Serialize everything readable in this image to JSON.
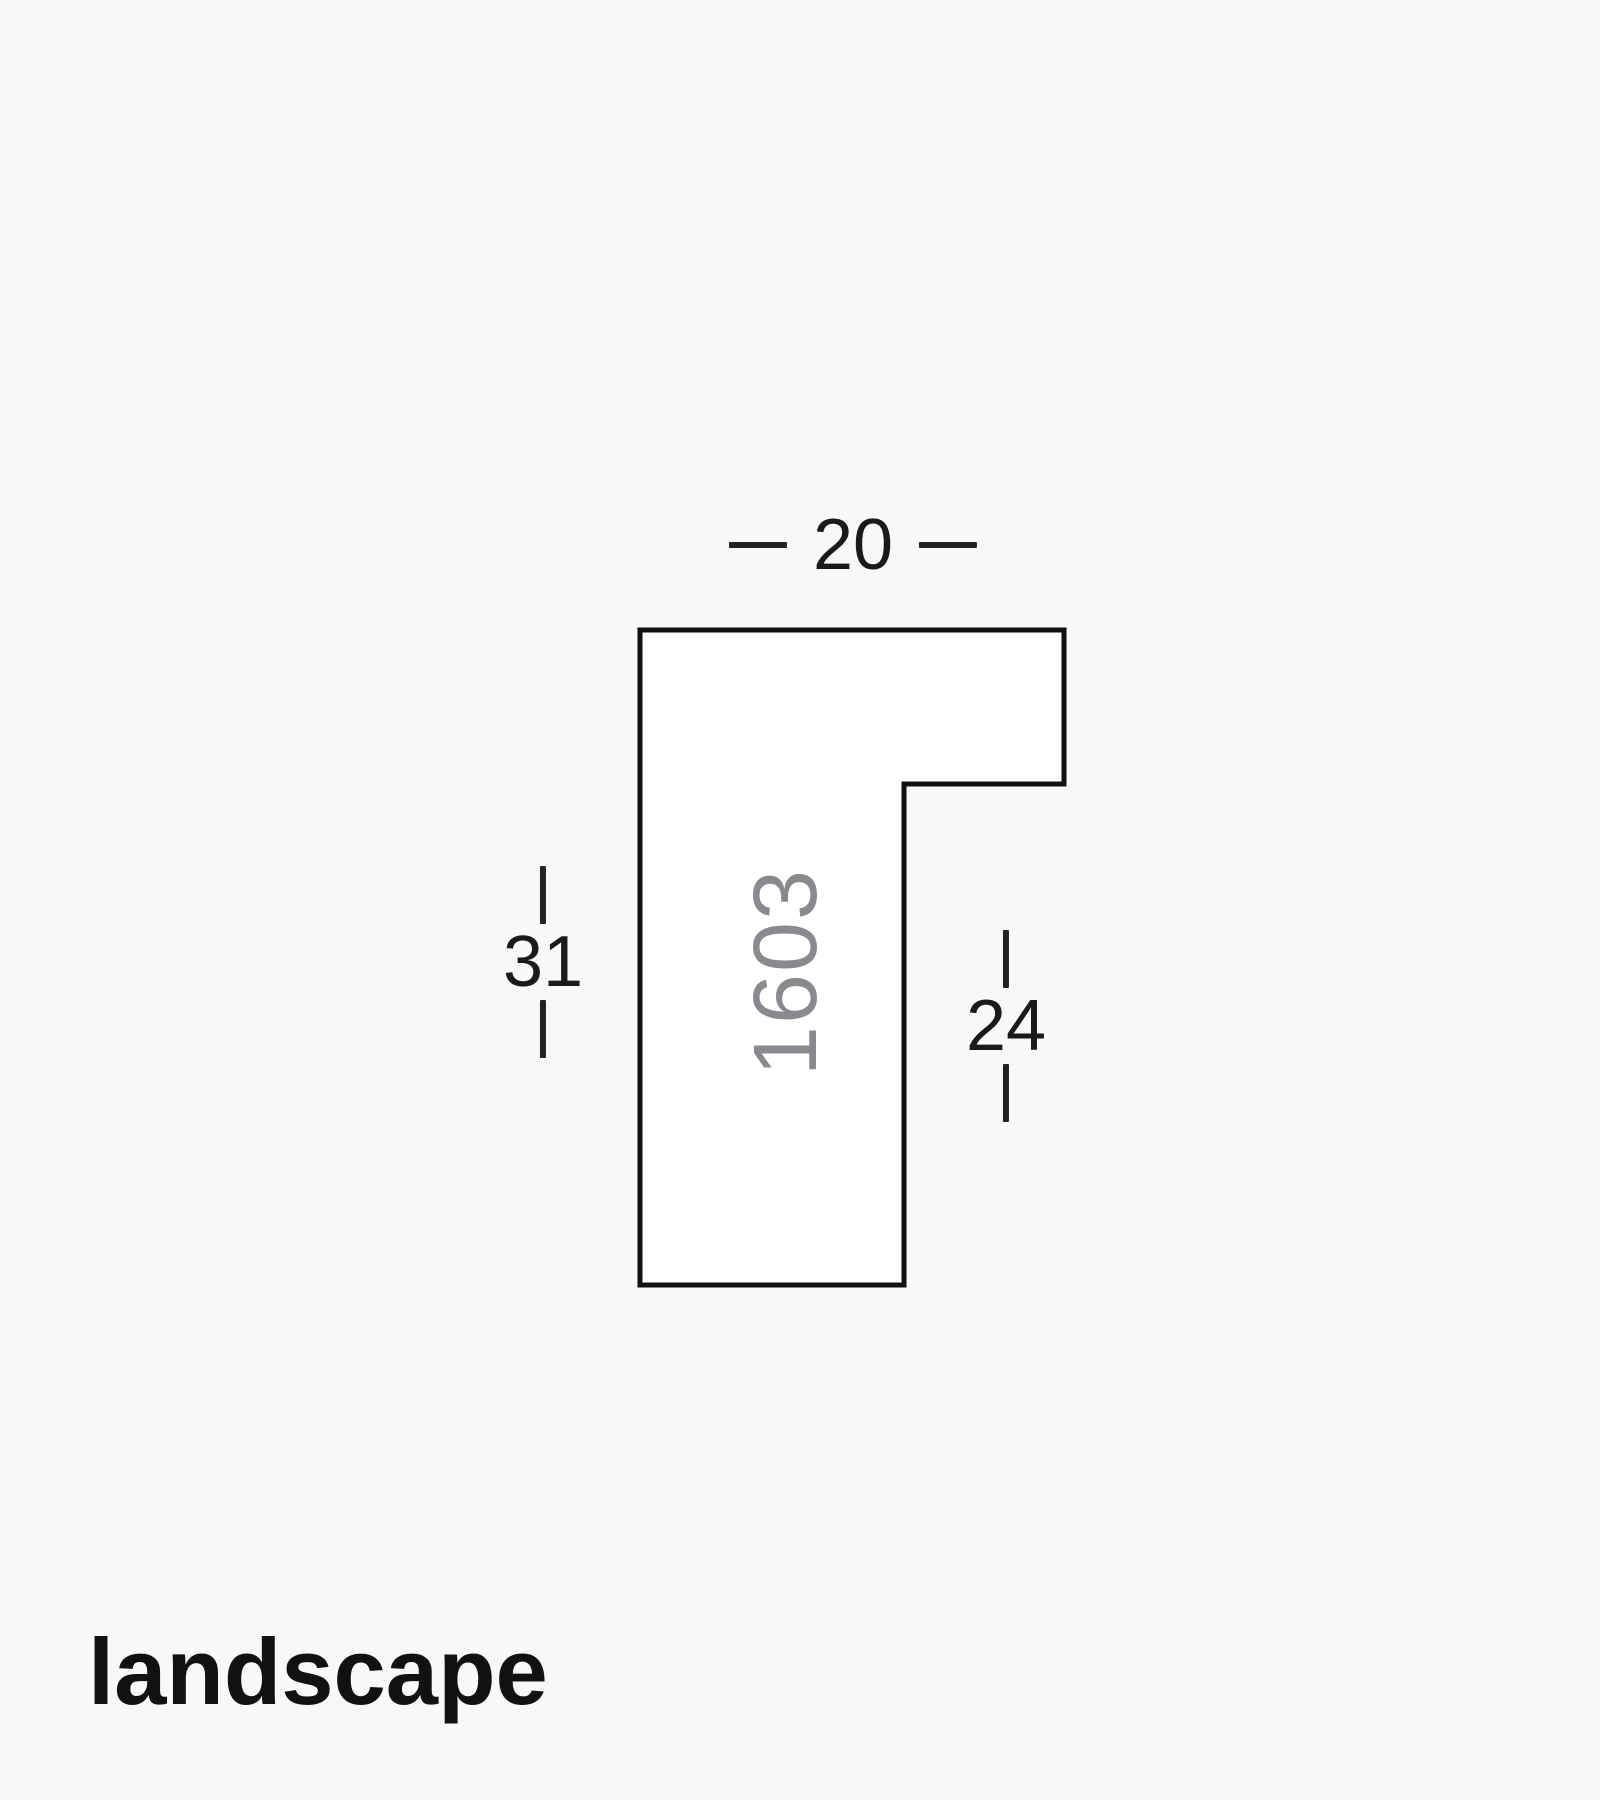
{
  "diagram": {
    "profile_code": "1603",
    "caption": "landscape",
    "dimensions": {
      "top_width": "20",
      "left_height": "31",
      "right_rebate_height": "24"
    },
    "colors": {
      "background": "#f8f8f8",
      "shape_fill": "#ffffff",
      "shape_outline": "#111111",
      "dimension_text": "#1a1a1a",
      "profile_code_text": "#8a8a8e",
      "caption_text": "#111111"
    }
  }
}
